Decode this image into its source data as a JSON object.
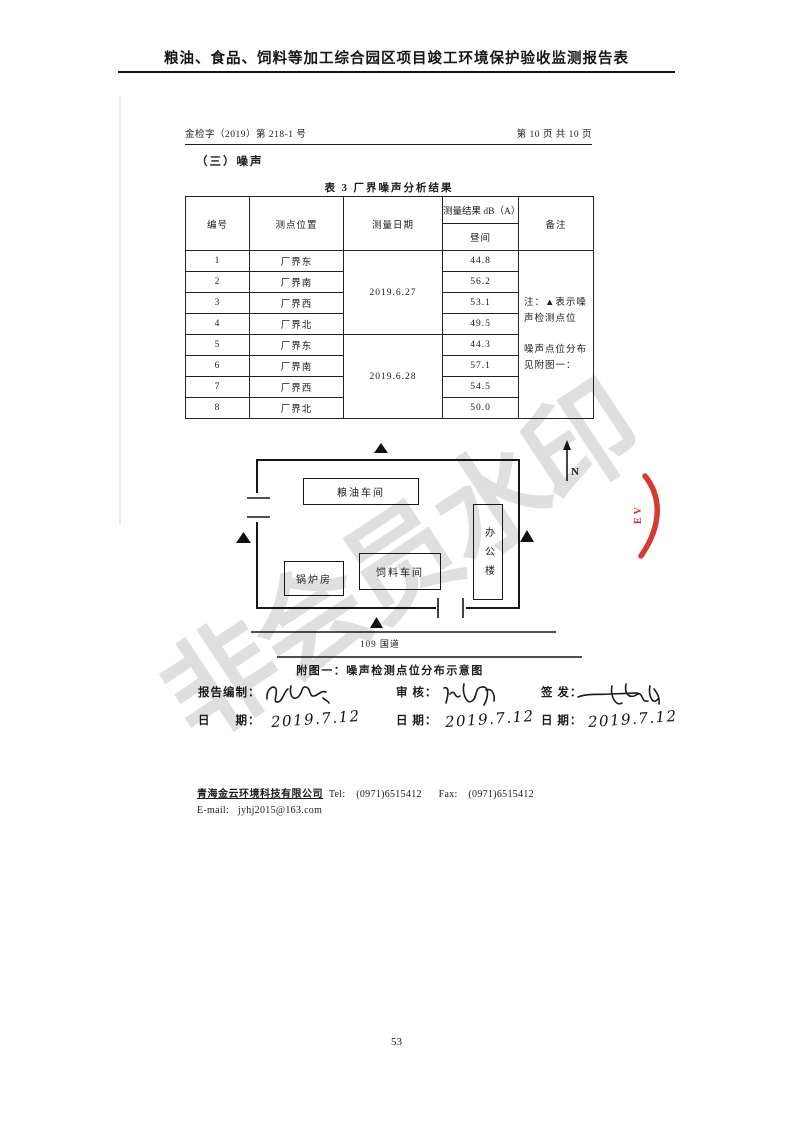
{
  "page": {
    "header_title": "粮油、食品、饲料等加工综合园区项目竣工环境保护验收监测报告表",
    "doc_number": "金检字（2019）第 218-1 号",
    "page_indicator": "第 10 页 共 10 页",
    "section_heading": "（三）噪声",
    "page_number": "53"
  },
  "table": {
    "caption": "表 3  厂界噪声分析结果",
    "headers": {
      "id": "编号",
      "location": "测点位置",
      "date": "测量日期",
      "result": "测量结果 dB（A）",
      "daytime": "昼间",
      "remark": "备注"
    },
    "date_groups": [
      "2019.6.27",
      "2019.6.28"
    ],
    "rows": [
      {
        "id": "1",
        "location": "厂界东",
        "value": "44.8"
      },
      {
        "id": "2",
        "location": "厂界南",
        "value": "56.2"
      },
      {
        "id": "3",
        "location": "厂界西",
        "value": "53.1"
      },
      {
        "id": "4",
        "location": "厂界北",
        "value": "49.5"
      },
      {
        "id": "5",
        "location": "厂界东",
        "value": "44.3"
      },
      {
        "id": "6",
        "location": "厂界南",
        "value": "57.1"
      },
      {
        "id": "7",
        "location": "厂界西",
        "value": "54.5"
      },
      {
        "id": "8",
        "location": "厂界北",
        "value": "50.0"
      }
    ],
    "remark_line1": "注：▲表示噪声检测点位",
    "remark_line2": "噪声点位分布见附图一："
  },
  "diagram": {
    "marker_symbol": "▲",
    "buildings": {
      "grain_oil": "粮油车间",
      "office": "办公楼",
      "boiler": "锅炉房",
      "feed": "饲料车间"
    },
    "north_label": "N",
    "road_label": "109 国道",
    "caption": "附图一：噪声检测点位分布示意图"
  },
  "signatures": {
    "prepared_label": "报告编制：",
    "reviewed_label": "审  核：",
    "issued_label": "签  发：",
    "date_label_wide": "日　　期：",
    "date_label": "日  期：",
    "prepared_date": "2019.7.12",
    "reviewed_date": "2019.7.12",
    "issued_date": "2019.7.12"
  },
  "footer": {
    "company": "青海金云环境科技有限公司",
    "tel_label": "Tel:",
    "tel": "(0971)6515412",
    "fax_label": "Fax:",
    "fax": "(0971)6515412",
    "email_label": "E-mail:",
    "email": "jyhj2015@163.com"
  },
  "stamp": {
    "letters": "EV",
    "color": "#d02b20"
  },
  "watermark": {
    "text": "非会员水印",
    "color": "#cccccc"
  }
}
